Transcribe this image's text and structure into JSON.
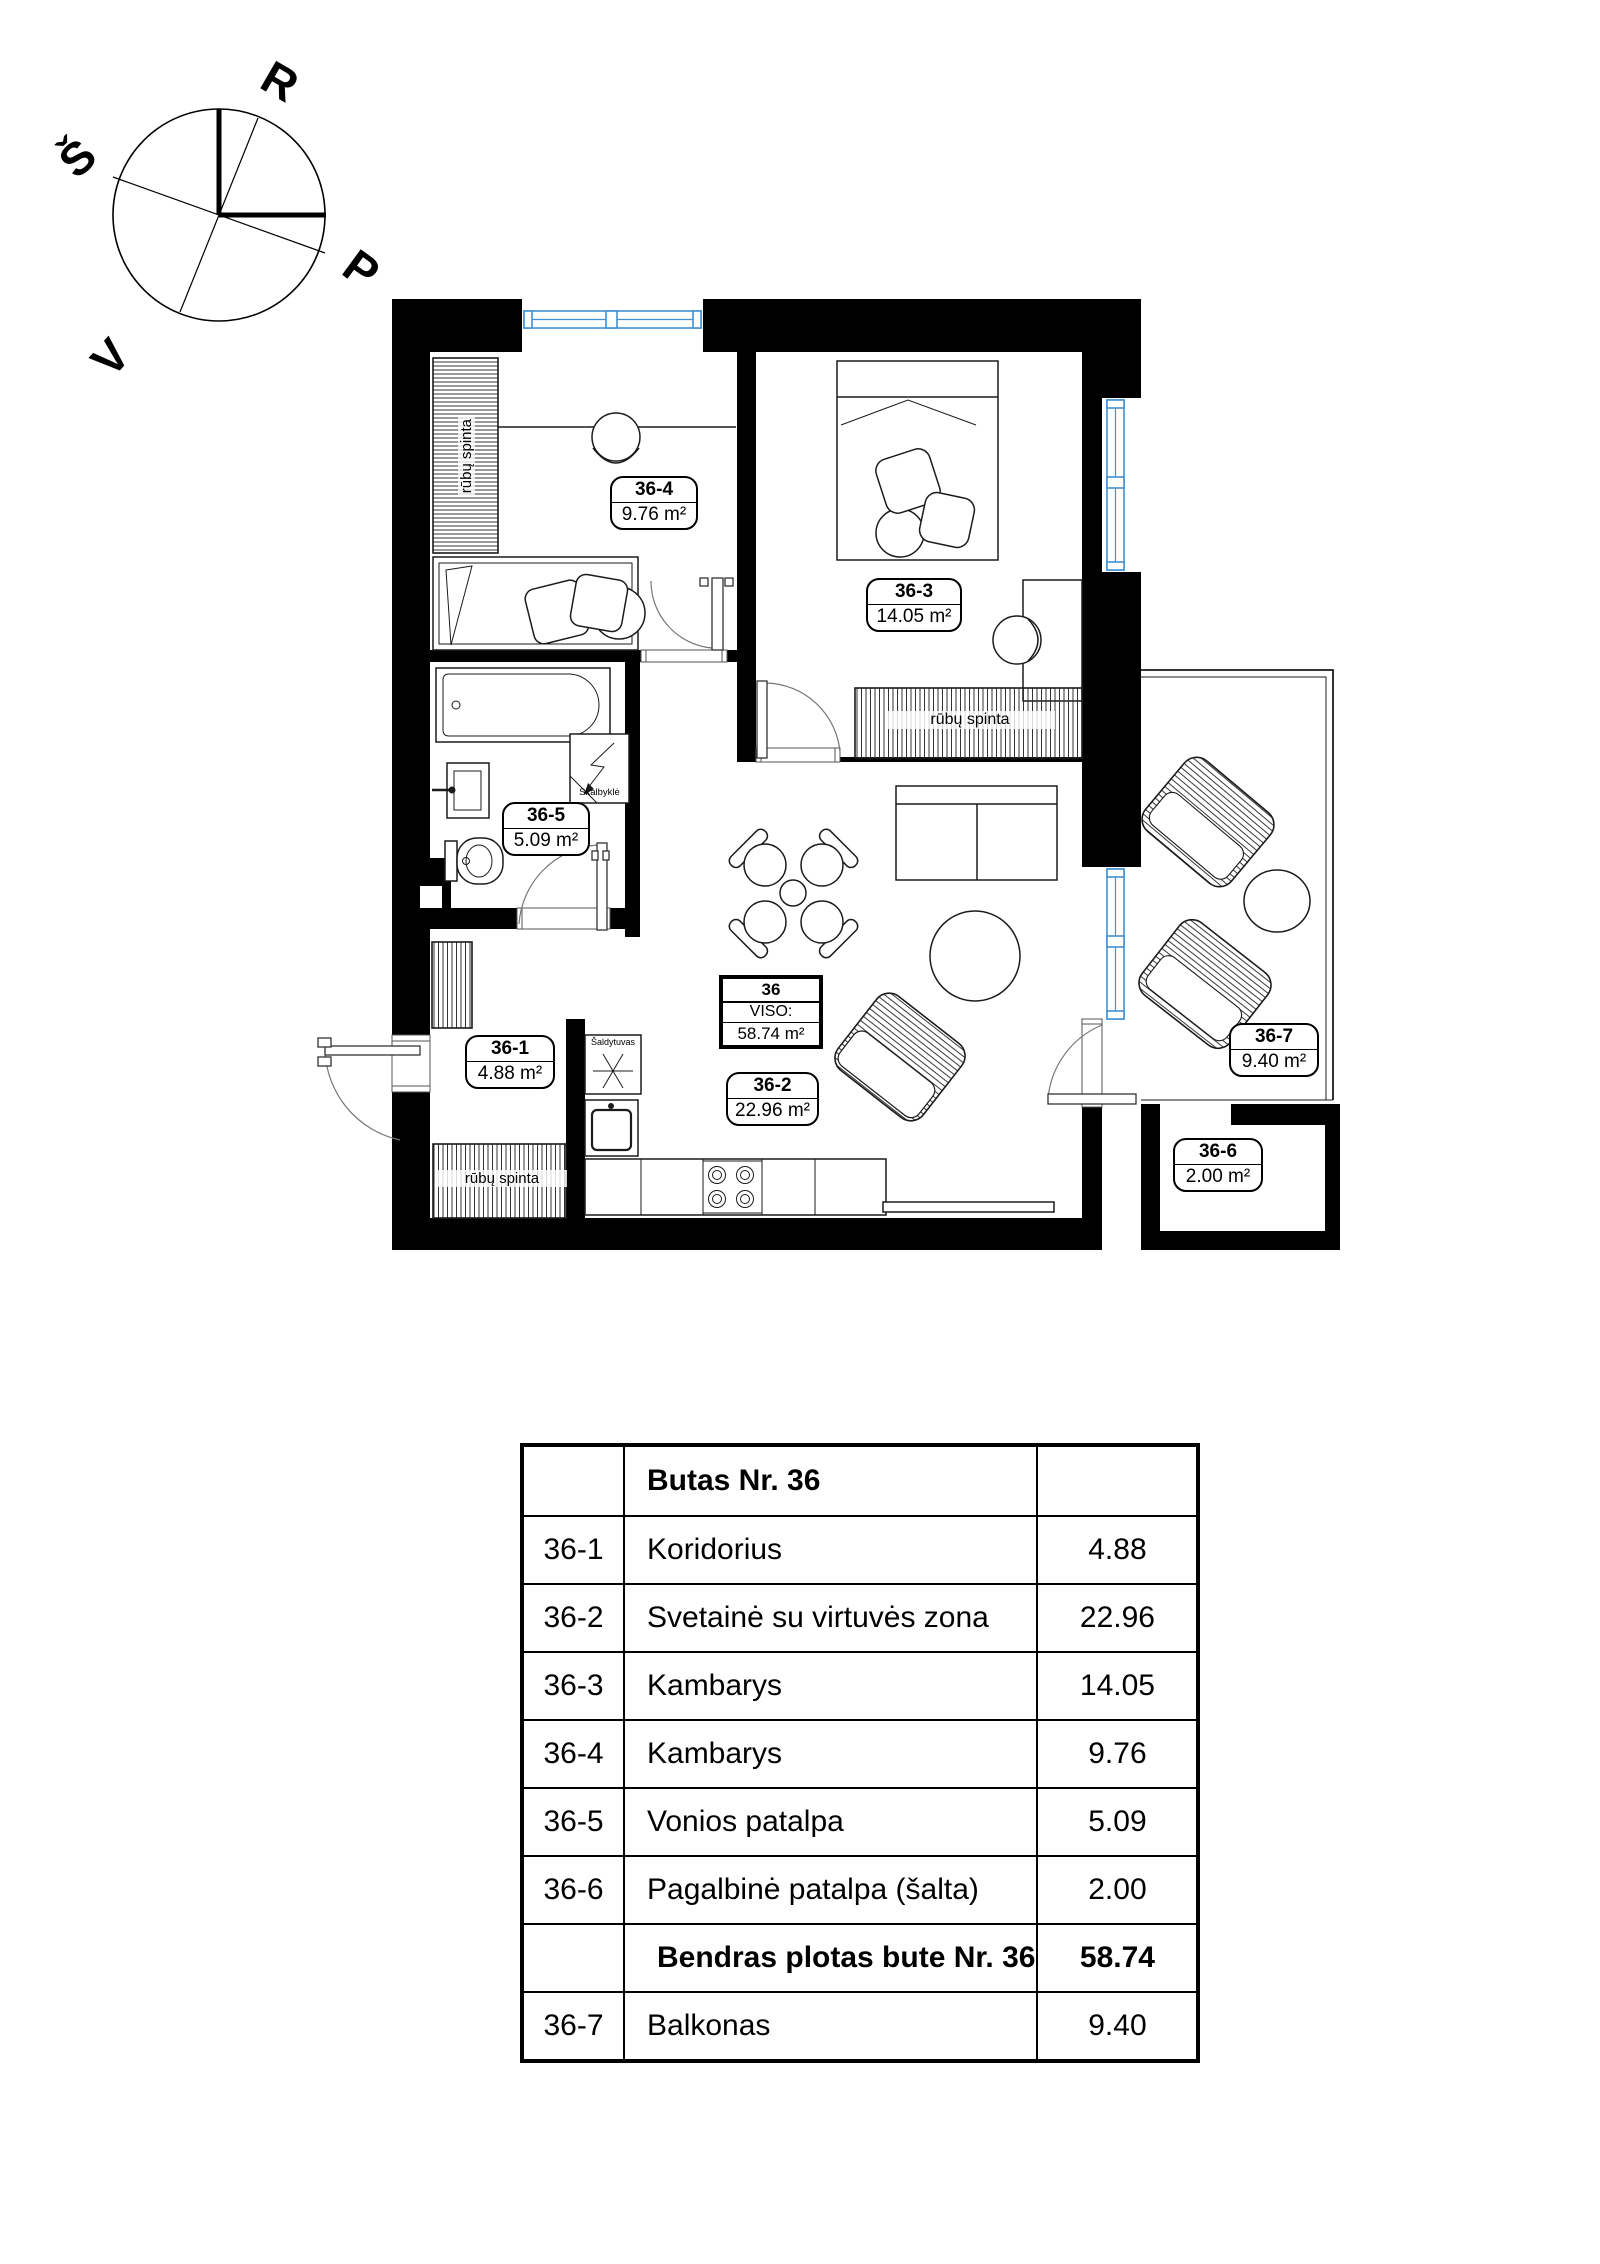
{
  "compass": {
    "north": "Š",
    "east": "R",
    "south": "P",
    "west": "V"
  },
  "plan": {
    "unit": {
      "number": "36",
      "viso_label": "VISO:",
      "total_area": "58.74 m²"
    },
    "rooms": [
      {
        "id": "36-1",
        "area": "4.88 m²"
      },
      {
        "id": "36-2",
        "area": "22.96 m²"
      },
      {
        "id": "36-3",
        "area": "14.05 m²"
      },
      {
        "id": "36-4",
        "area": "9.76 m²"
      },
      {
        "id": "36-5",
        "area": "5.09 m²"
      },
      {
        "id": "36-6",
        "area": "2.00 m²"
      },
      {
        "id": "36-7",
        "area": "9.40 m²"
      }
    ],
    "annotations": {
      "wardrobe": "rūbų spinta",
      "washer": "Skalbyklė",
      "fridge": "Šaldytuvas"
    },
    "colors": {
      "window": "#4191d2",
      "wall": "#000000"
    }
  },
  "table": {
    "header": "Butas Nr. 36",
    "rows": [
      {
        "id": "36-1",
        "name": "Koridorius",
        "area": "4.88"
      },
      {
        "id": "36-2",
        "name": "Svetainė su virtuvės  zona",
        "area": "22.96"
      },
      {
        "id": "36-3",
        "name": "Kambarys",
        "area": "14.05"
      },
      {
        "id": "36-4",
        "name": "Kambarys",
        "area": "9.76"
      },
      {
        "id": "36-5",
        "name": "Vonios patalpa",
        "area": "5.09"
      },
      {
        "id": "36-6",
        "name": "Pagalbinė patalpa (šalta)",
        "area": "2.00"
      }
    ],
    "total": {
      "name": "Bendras plotas  bute Nr. 36",
      "area": "58.74"
    },
    "balcony_row": {
      "id": "36-7",
      "name": "Balkonas",
      "area": "9.40"
    }
  }
}
